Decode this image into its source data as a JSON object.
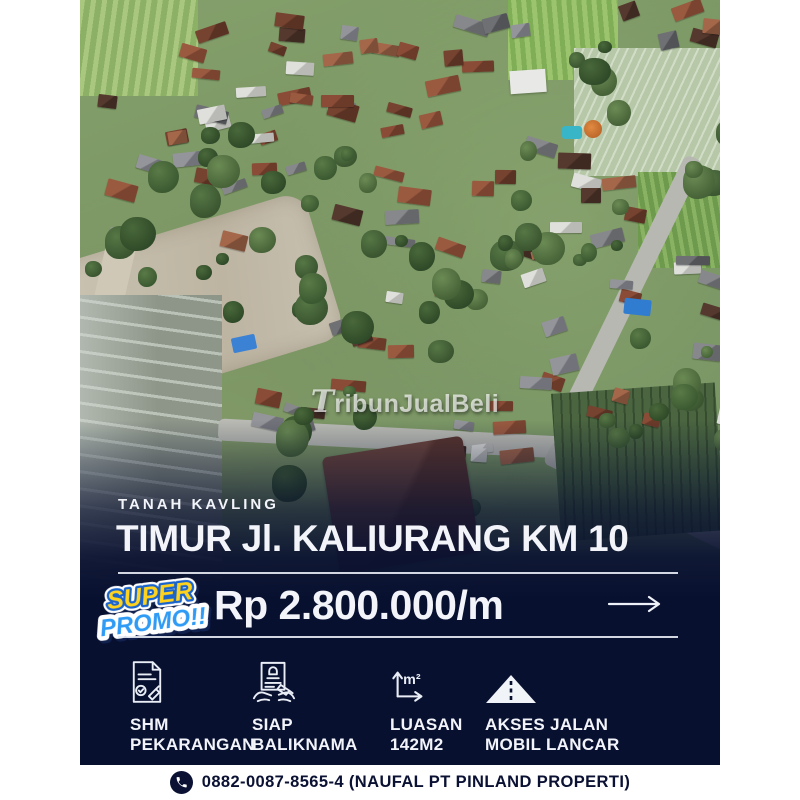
{
  "poster": {
    "watermark": "TribunJualBeli",
    "kicker": "TANAH KAVLING",
    "title": "TIMUR Jl. KALIURANG KM 10",
    "promo": {
      "line1": "SUPER",
      "line2": "PROMO!!"
    },
    "price": "Rp 2.800.000/m",
    "area_unit": "m²",
    "features": [
      {
        "icon": "shm-document-icon",
        "line1": "SHM",
        "line2": "PEKARANGAN"
      },
      {
        "icon": "balik-nama-certificate-icon",
        "line1": "SIAP",
        "line2": "BALIKNAMA"
      },
      {
        "icon": "area-m2-icon",
        "line1": "LUASAN",
        "line2": "142M2"
      },
      {
        "icon": "road-access-icon",
        "line1": "AKSES JALAN",
        "line2": "MOBIL LANCAR"
      }
    ],
    "contact": {
      "phone": "0882-0087-8565-4 (NAUFAL PT PINLAND PROPERTI)"
    }
  },
  "colors": {
    "navy": "#081030",
    "promo_yellow": "#ffd21e",
    "promo_blue": "#2f9bf5",
    "promo_outline_blue": "#1a64cb",
    "contact_text": "#0a1133",
    "white": "#ffffff"
  }
}
